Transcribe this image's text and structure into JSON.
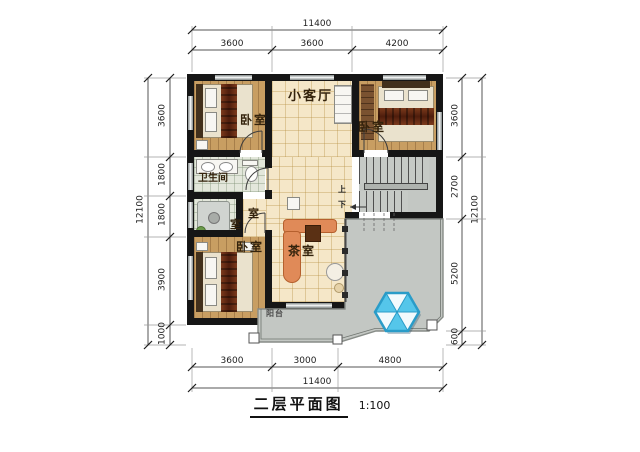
{
  "title": {
    "text": "二层平面图",
    "scale": "1:100"
  },
  "dims": {
    "top_overall": "11400",
    "top_segs": [
      "3600",
      "3600",
      "4200"
    ],
    "bottom_overall": "11400",
    "bottom_segs": [
      "3600",
      "3000",
      "4800"
    ],
    "left_overall": "12100",
    "left_segs": [
      "3600",
      "1800",
      "1800",
      "3900",
      "1000"
    ],
    "right_overall": "12100",
    "right_segs": [
      "3600",
      "2700",
      "5200",
      "600"
    ]
  },
  "rooms": {
    "living": "小客厅",
    "bedroom_tl": "卧室",
    "bedroom_tr": "卧室",
    "bedroom_bl": "卧室",
    "bathroom": "卫生间",
    "tea_room": "茶室",
    "balcony": "阳台",
    "partial_a": "室",
    "partial_b": "室"
  },
  "stairs": {
    "up": "上",
    "down": "下"
  },
  "colors": {
    "wall": "#161616",
    "wood_floor": "#c89e62",
    "tile_floor": "#f5e7c8",
    "bath_tile": "#e3e7db",
    "outdoor_gray": "#c3c7c3",
    "sofa": "#e08a58",
    "bed_runner": "#6b2e14",
    "skylight_blue": "#55c6ea"
  }
}
